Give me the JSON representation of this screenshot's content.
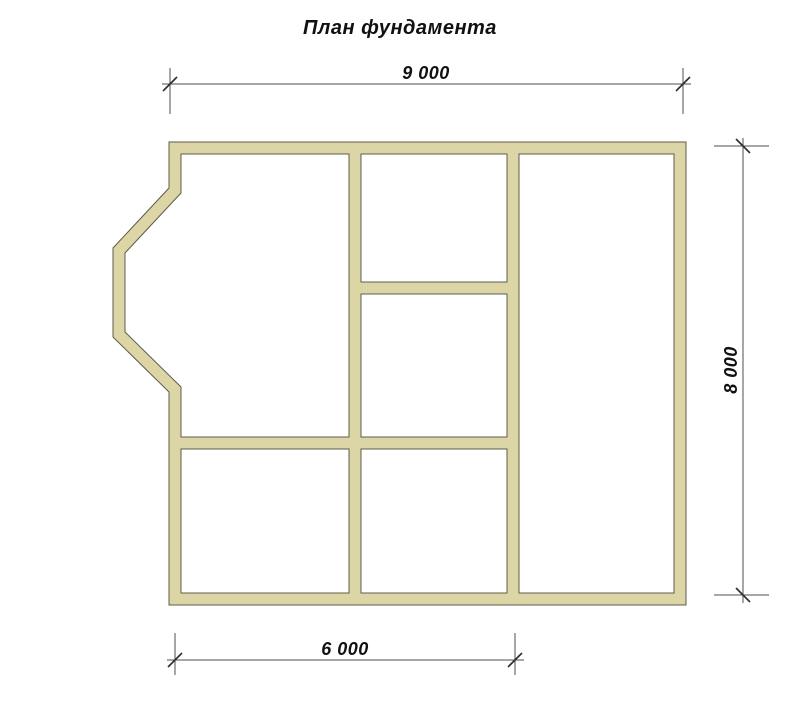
{
  "title": "План фундамента",
  "drawing": {
    "type": "foundation-plan",
    "dimensions": {
      "top": {
        "label": "9 000",
        "side": "top"
      },
      "right": {
        "label": "8 000",
        "side": "right"
      },
      "bottom": {
        "label": "6 000",
        "side": "bottom"
      }
    },
    "colors": {
      "background": "#ffffff",
      "wall_fill": "#dcd5a5",
      "wall_outline": "#5c5c4a",
      "dimension_line": "#4f4f4f",
      "tick": "#2f2f2f",
      "text": "#111111"
    }
  }
}
